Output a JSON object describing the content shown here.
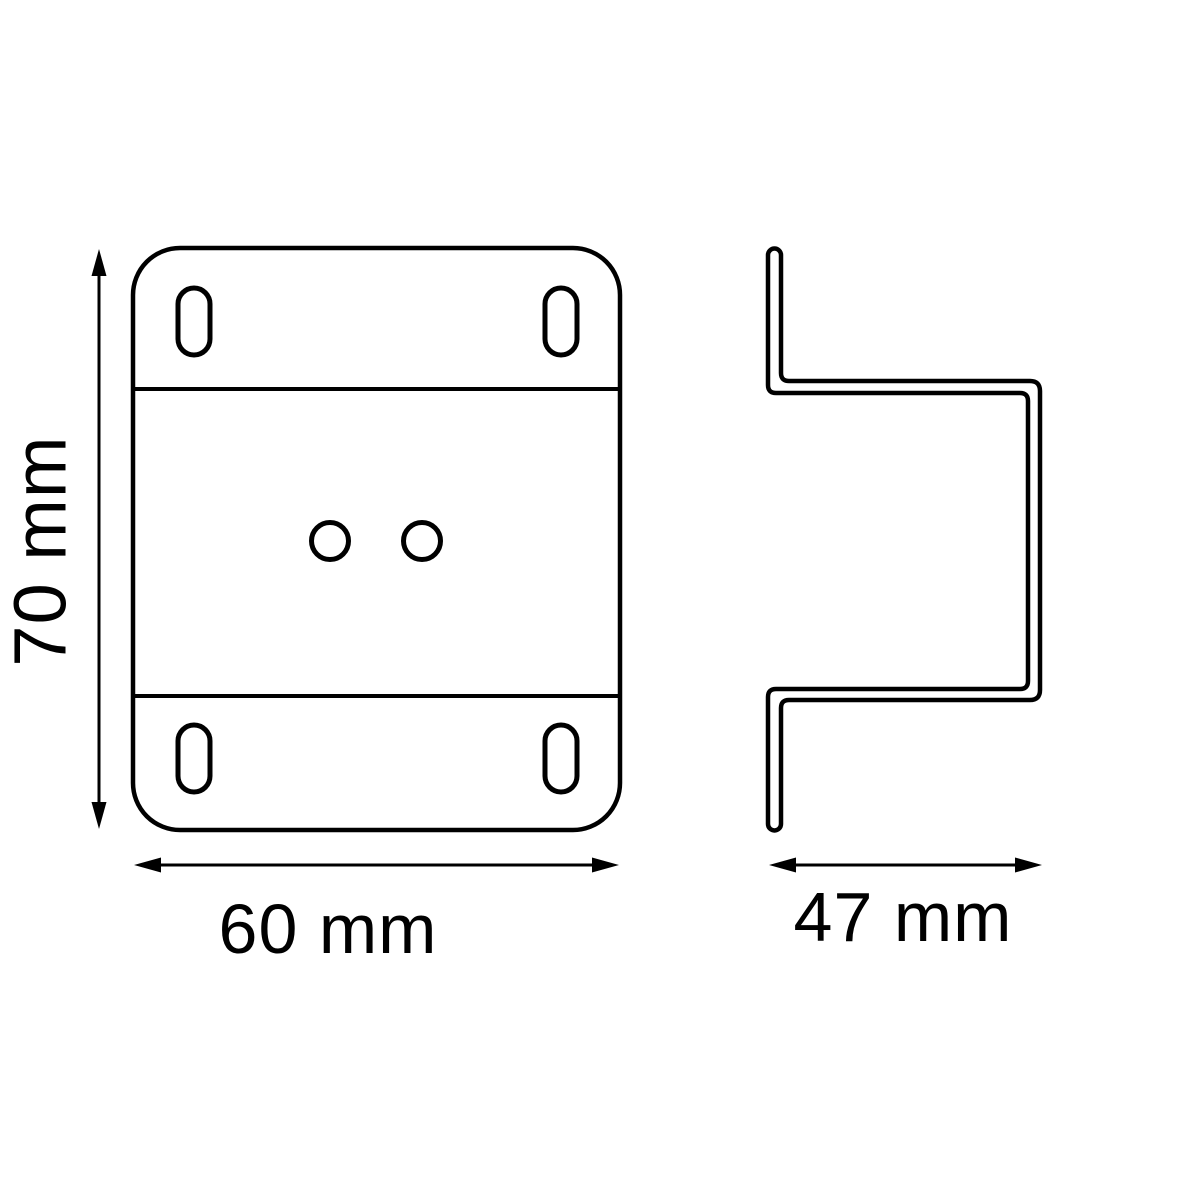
{
  "drawing": {
    "front_view": {
      "height_label": "70 mm",
      "width_label": "60 mm"
    },
    "side_view": {
      "depth_label": "47 mm"
    },
    "colors": {
      "line": "#000000",
      "background": "#ffffff"
    }
  }
}
